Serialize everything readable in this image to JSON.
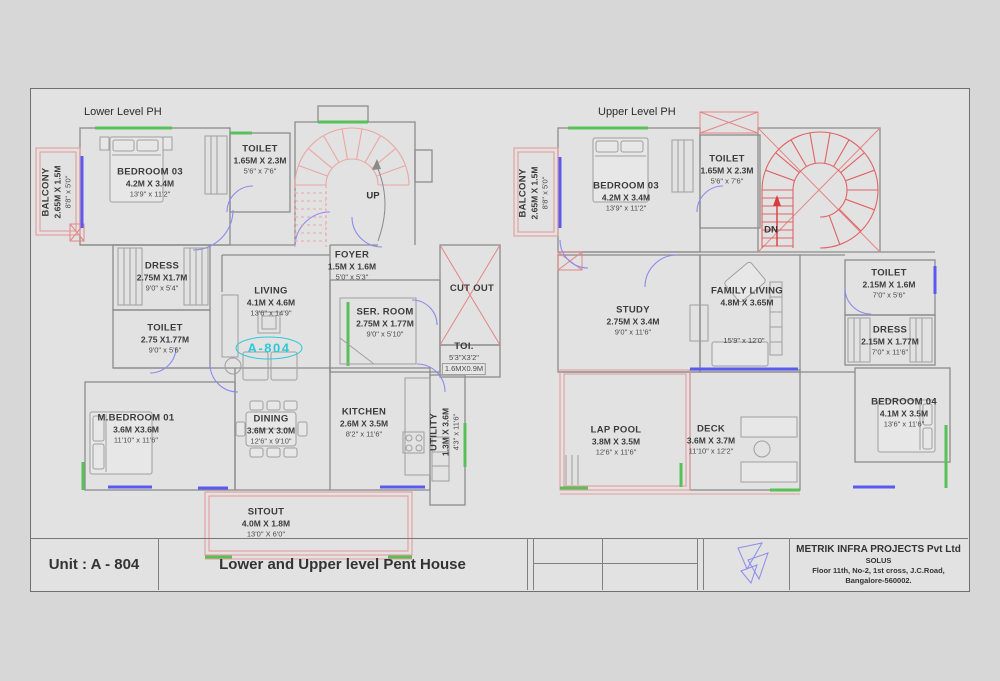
{
  "titles": {
    "lower": "Lower Level PH",
    "upper": "Upper Level PH"
  },
  "annotations": {
    "up": "UP",
    "dn": "DN",
    "cut_out": "CUT OUT",
    "unit_tag": "A-804"
  },
  "lower_rooms": {
    "balcony": {
      "name": "BALCONY",
      "m": "2.65M X 1.5M",
      "ft": "8'8\" x 5'0\""
    },
    "bedroom03": {
      "name": "BEDROOM 03",
      "m": "4.2M X 3.4M",
      "ft": "13'9\" x 11'2\""
    },
    "toilet_top": {
      "name": "TOILET",
      "m": "1.65M X 2.3M",
      "ft": "5'6\" x 7'6\""
    },
    "dress": {
      "name": "DRESS",
      "m": "2.75M X1.7M",
      "ft": "9'0\" x 5'4\""
    },
    "toilet_mid": {
      "name": "TOILET",
      "m": "2.75 X1.77M",
      "ft": "9'0\" x 5'6\""
    },
    "living": {
      "name": "LIVING",
      "m": "4.1M X 4.6M",
      "ft": "13'6\" x 14'9\""
    },
    "foyer": {
      "name": "FOYER",
      "m": "1.5M X 1.6M",
      "ft": "5'0\" x 5'3\""
    },
    "ser_room": {
      "name": "SER. ROOM",
      "m": "2.75M X 1.77M",
      "ft": "9'0\" x 5'10\""
    },
    "toi": {
      "name": "TOI.",
      "ft": "5'3\"X3'2\"",
      "m": "1.6MX0.9M"
    },
    "m_bedroom01": {
      "name": "M.BEDROOM 01",
      "m": "3.6M X3.6M",
      "ft": "11'10\" x 11'6\""
    },
    "dining": {
      "name": "DINING",
      "m": "3.6M X 3.0M",
      "ft": "12'6\" x 9'10\""
    },
    "kitchen": {
      "name": "KITCHEN",
      "m": "2.6M X 3.5M",
      "ft": "8'2\" x 11'6\""
    },
    "utility": {
      "name": "UTILITY",
      "m": "1.3M X 3.6M",
      "ft": "4'3\" x 11'6\""
    },
    "sitout": {
      "name": "SITOUT",
      "m": "4.0M X 1.8M",
      "ft": "13'0\" X 6'0\""
    }
  },
  "upper_rooms": {
    "balcony": {
      "name": "BALCONY",
      "m": "2.65M X 1.5M",
      "ft": "8'8\" x 5'0\""
    },
    "bedroom03": {
      "name": "BEDROOM 03",
      "m": "4.2M X 3.4M",
      "ft": "13'9\" x 11'2\""
    },
    "toilet": {
      "name": "TOILET",
      "m": "1.65M X 2.3M",
      "ft": "5'6\" x 7'6\""
    },
    "study": {
      "name": "STUDY",
      "m": "2.75M X 3.4M",
      "ft": "9'0\" x 11'6\""
    },
    "family_living": {
      "name": "FAMILY LIVING",
      "m": "4.8M X 3.65M",
      "ft": "15'9\" x 12'0\""
    },
    "toilet_r": {
      "name": "TOILET",
      "m": "2.15M X 1.6M",
      "ft": "7'0\" x 5'6\""
    },
    "dress_r": {
      "name": "DRESS",
      "m": "2.15M X 1.77M",
      "ft": "7'0\" x 11'6\""
    },
    "bedroom04": {
      "name": "BEDROOM 04",
      "m": "4.1M X 3.5M",
      "ft": "13'6\" x 11'6\""
    },
    "lap_pool": {
      "name": "LAP POOL",
      "m": "3.8M X 3.5M",
      "ft": "12'6\" x 11'6\""
    },
    "deck": {
      "name": "DECK",
      "m": "3.6M X 3.7M",
      "ft": "11'10\" x 12'2\""
    }
  },
  "title_block": {
    "unit": "Unit : A - 804",
    "drawing_title": "Lower and Upper level Pent House",
    "company_name": "METRIK INFRA PROJECTS Pvt Ltd",
    "company_line2": "SOLUS",
    "company_line3": "Floor 11th, No-2, 1st cross, J.C.Road,",
    "company_line4": "Bangalore-560002."
  },
  "colors": {
    "wall": "#8c8c8c",
    "accent_green": "#58c058",
    "window_blue": "#5a5af0",
    "stair_pink": "#eba6a6",
    "stair_red": "#e06464",
    "cut_red": "#e58484",
    "tag_cyan": "#2fc8d8"
  }
}
